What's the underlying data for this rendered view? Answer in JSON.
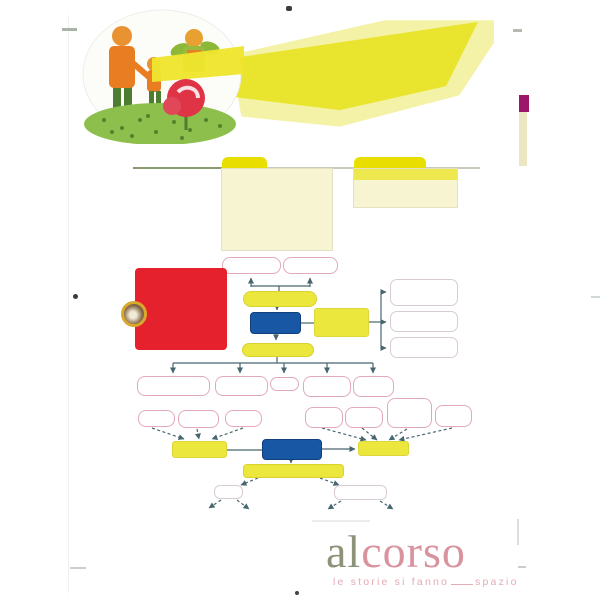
{
  "document": {
    "type": "textbook-page-scan",
    "content": "concept map page with empty nodes, two blank folder panels and a family-garden illustration"
  },
  "brand": {
    "word_left": "al",
    "word_right": "corso",
    "tagline_pre": "le storie si fanno",
    "tagline_post": "spazio"
  },
  "colors": {
    "red": "#e6212e",
    "blue": "#1857a4",
    "yellow-bright": "#ece73c",
    "yellow-tab": "#e8df00",
    "yellow-pale": "#f7f4d2",
    "banner-pale": "#f4f2a6",
    "banner-bright": "#e9e42e",
    "pink-border": "#e2a9bc",
    "gray-border": "#d8ccd4",
    "line": "#47666f",
    "magenta": "#9c1769",
    "cream": "#ebe7c3",
    "brand-al": "#8d9379",
    "brand-corso": "#d9939f",
    "brand-tagline": "#e4abb5"
  }
}
